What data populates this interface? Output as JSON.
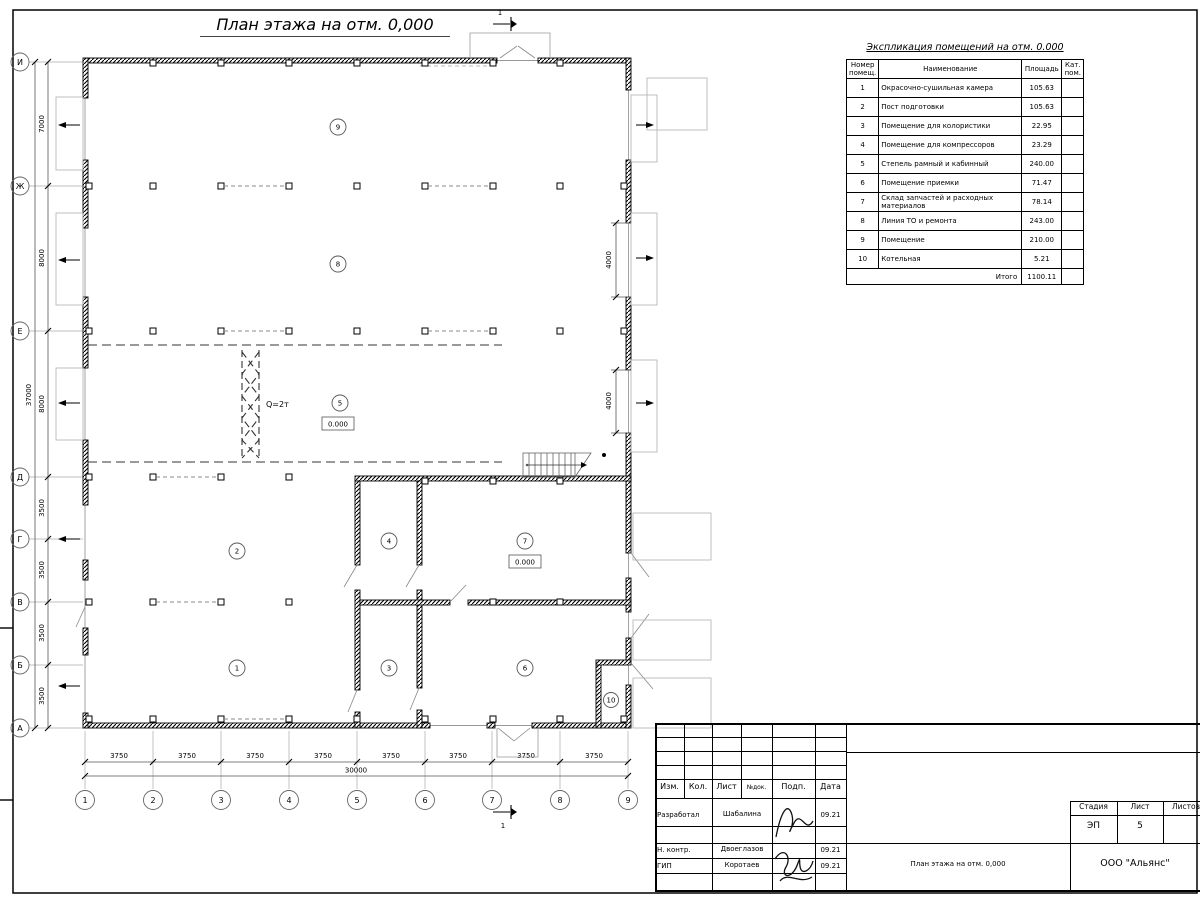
{
  "sheet": {
    "title": "План этажа на отм. 0,000",
    "section_mark": "1"
  },
  "axes": {
    "rows": [
      "И",
      "Ж",
      "Е",
      "Д",
      "Г",
      "В",
      "Б",
      "А"
    ],
    "cols": [
      "1",
      "2",
      "3",
      "4",
      "5",
      "6",
      "7",
      "8",
      "9"
    ]
  },
  "dimensions": {
    "left_segments": [
      "7000",
      "8000",
      "8000",
      "3500",
      "3500",
      "3500",
      "3500"
    ],
    "left_total": "37000",
    "bottom_segments": [
      "3750",
      "3750",
      "3750",
      "3750",
      "3750",
      "3750",
      "3750",
      "3750"
    ],
    "bottom_total": "30000",
    "right_gates": [
      "4000",
      "4000"
    ]
  },
  "plan": {
    "rooms": [
      "1",
      "2",
      "3",
      "4",
      "5",
      "6",
      "7",
      "8",
      "9",
      "10"
    ],
    "elevation_mark": "0.000",
    "elevation_mark_2": "0.000",
    "crane_label": "Q=2т"
  },
  "schedule": {
    "title": "Экспликация помещений на отм. 0.000",
    "headers": {
      "num_line1": "Номер",
      "num_line2": "помещ.",
      "name": "Наименование",
      "area": "Площадь",
      "cat_line1": "Кат.",
      "cat_line2": "пом."
    },
    "rows": [
      {
        "num": "1",
        "name": "Окрасочно-сушильная камера",
        "area": "105.63"
      },
      {
        "num": "2",
        "name": "Пост подготовки",
        "area": "105.63"
      },
      {
        "num": "3",
        "name": "Помещение для колористики",
        "area": "22.95"
      },
      {
        "num": "4",
        "name": "Помещение для компрессоров",
        "area": "23.29"
      },
      {
        "num": "5",
        "name": "Степель рамный и кабинный",
        "area": "240.00"
      },
      {
        "num": "6",
        "name": "Помещение приемки",
        "area": "71.47"
      },
      {
        "num": "7",
        "name": "Склад запчастей и расходных материалов",
        "area": "78.14"
      },
      {
        "num": "8",
        "name": "Линия ТО и ремонта",
        "area": "243.00"
      },
      {
        "num": "9",
        "name": "Помещение",
        "area": "210.00"
      },
      {
        "num": "10",
        "name": "Котельная",
        "area": "5.21"
      }
    ],
    "total_label": "Итого",
    "total_value": "1100.11"
  },
  "titleblock": {
    "columns": [
      "Изм.",
      "Кол.",
      "Лист",
      "№док.",
      "Подп.",
      "Дата"
    ],
    "rows": [
      {
        "role": "Разработал",
        "name": "Шабалина",
        "date": "09.21"
      },
      {
        "role": "Н. контр.",
        "name": "Двоеглазов",
        "date": "09.21"
      },
      {
        "role": "ГИП",
        "name": "Коротаев",
        "date": "09.21"
      }
    ],
    "stage_label": "Стадия",
    "sheet_label": "Лист",
    "sheets_label": "Листов",
    "stage": "ЭП",
    "sheet_num": "5",
    "doc_title": "План этажа на отм. 0,000",
    "company": "ООО \"Альянс\""
  }
}
